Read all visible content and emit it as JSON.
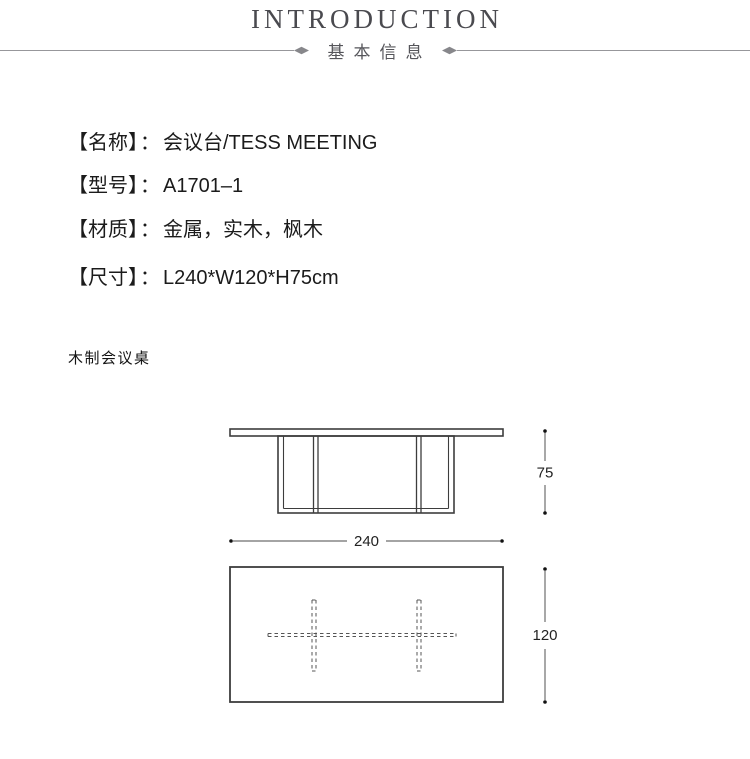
{
  "header": {
    "title": "INTRODUCTION",
    "subtitle": "基本信息"
  },
  "specs": [
    {
      "label": "【名称】",
      "sep": "：",
      "value": "会议台/TESS MEETING"
    },
    {
      "label": "【型号】",
      "sep": "：",
      "value": "A1701–1"
    },
    {
      "label": "【材质】",
      "sep": "：",
      "value": "金属，实木，枫木"
    },
    {
      "label": "【尺寸】",
      "sep": "：",
      "value": "L240*W120*H75cm"
    }
  ],
  "note": "木制会议桌",
  "drawing": {
    "front_view": {
      "height_label": "75",
      "width_label": "240"
    },
    "top_view": {
      "depth_label": "120"
    }
  },
  "colors": {
    "title_text": "#4a4a4f",
    "subtitle_text": "#55555a",
    "divider_line": "#97979b",
    "diamond": "#87878b",
    "body_text": "#1b1b1b",
    "drawing_stroke": "#3d3d3d",
    "dashed_line": "#555555",
    "dimension_line": "#6e6e6e",
    "dimension_dot": "#111111",
    "dimension_text": "#222222",
    "background": "#ffffff"
  }
}
